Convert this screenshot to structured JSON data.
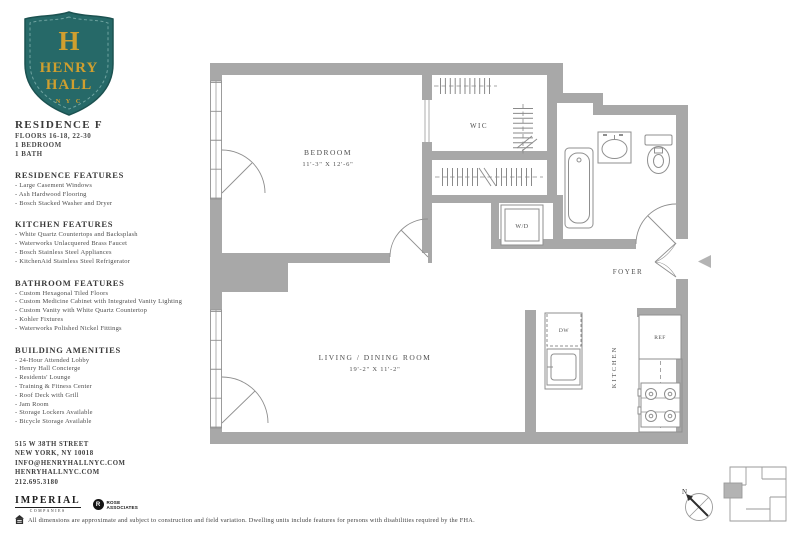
{
  "colors": {
    "teal": "#266968",
    "teal_dark": "#1c5251",
    "gold": "#cf9f2f",
    "wall": "#a8a8a8",
    "line": "#8f8f8f",
    "text": "#444444"
  },
  "logo": {
    "monogram": "H",
    "name_line1": "HENRY",
    "name_line2": "HALL",
    "city": "N Y C"
  },
  "residence": {
    "name": "RESIDENCE F",
    "floors": "FLOORS 16-18, 22-30",
    "bedrooms": "1 BEDROOM",
    "baths": "1 BATH"
  },
  "sections": [
    {
      "heading": "RESIDENCE FEATURES",
      "items": [
        "Large Casement Windows",
        "Ash Hardwood Flooring",
        "Bosch Stacked Washer and Dryer"
      ]
    },
    {
      "heading": "KITCHEN FEATURES",
      "items": [
        "White Quartz Countertops and Backsplash",
        "Waterworks Unlacquered Brass Faucet",
        "Bosch Stainless Steel Appliances",
        "KitchenAid Stainless Steel Refrigerator"
      ]
    },
    {
      "heading": "BATHROOM FEATURES",
      "items": [
        "Custom Hexagonal Tiled Floors",
        "Custom Medicine Cabinet with Integrated Vanity Lighting",
        "Custom Vanity with White Quartz Countertop",
        "Kohler Fixtures",
        "Waterworks Polished Nickel Fittings"
      ]
    },
    {
      "heading": "BUILDING AMENITIES",
      "items": [
        "24-Hour Attended Lobby",
        "Henry Hall Concierge",
        "Residents' Lounge",
        "Training & Fitness Center",
        "Roof Deck with Grill",
        "Jam Room",
        "Storage Lockers Available",
        "Bicycle Storage Available"
      ]
    }
  ],
  "contact": {
    "address_line1": "515 W 38TH STREET",
    "address_line2": "NEW YORK, NY 10018",
    "email": "INFO@HENRYHALLNYC.COM",
    "website": "HENRYHALLNYC.COM",
    "phone": "212.695.3180"
  },
  "developers": {
    "imperial": "IMPERIAL",
    "imperial_sub": "COMPANIES",
    "rose_initial": "R",
    "rose": "ROSE",
    "rose_sub": "ASSOCIATES"
  },
  "disclaimer": "All dimensions are approximate and subject to construction and field variation. Dwelling units include features for persons with disabilities required by the FHA.",
  "plan": {
    "bedroom_label": "BEDROOM",
    "bedroom_dims": "11'-3\" X 12'-6\"",
    "living_label": "LIVING / DINING ROOM",
    "living_dims": "19'-2\" X 11'-2\"",
    "wic": "WIC",
    "wd": "W/D",
    "foyer": "FOYER",
    "kitchen": "KITCHEN",
    "dw": "DW",
    "ref": "REF"
  },
  "compass": {
    "north": "N"
  }
}
